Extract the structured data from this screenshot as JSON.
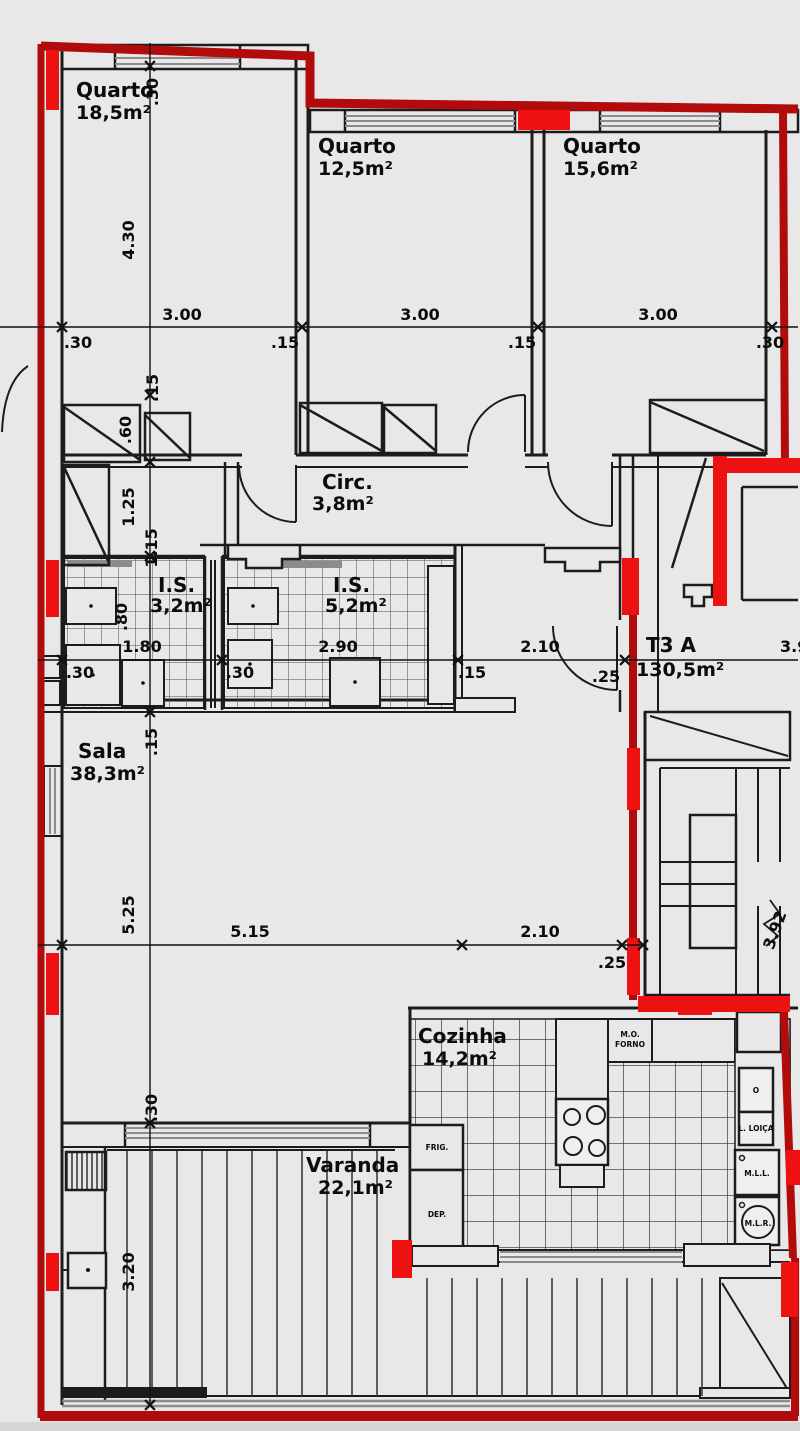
{
  "unit": {
    "code": "T3 A",
    "area": "130,5m²"
  },
  "rooms": {
    "quarto1": {
      "name": "Quarto",
      "area": "18,5m²"
    },
    "quarto2": {
      "name": "Quarto",
      "area": "12,5m²"
    },
    "quarto3": {
      "name": "Quarto",
      "area": "15,6m²"
    },
    "circ": {
      "name": "Circ.",
      "area": "3,8m²"
    },
    "is1": {
      "name": "I.S.",
      "area": "3,2m²"
    },
    "is2": {
      "name": "I.S.",
      "area": "5,2m²"
    },
    "sala": {
      "name": "Sala",
      "area": "38,3m²"
    },
    "cozinha": {
      "name": "Cozinha",
      "area": "14,2m²"
    },
    "varanda": {
      "name": "Varanda",
      "area": "22,1m²"
    }
  },
  "appliances": {
    "mo": "M.O.",
    "forno": "FORNO",
    "frig": "FRIG.",
    "dep": "DEP.",
    "o": "O",
    "lloica": "L. LOIÇA",
    "mll": "M.L.L.",
    "mlr": "M.L.R."
  },
  "dims": {
    "top_30l": ".30",
    "top_300a": "3.00",
    "top_15a": ".15",
    "top_300b": "3.00",
    "top_15b": ".15",
    "top_300c": "3.00",
    "top_30r": ".30",
    "v_30a": ".30",
    "v_430": "4.30",
    "v_15a": ".15",
    "v_60": ".60",
    "v_125": "1.25",
    "v_115": "1.15",
    "v_15b": ".15",
    "v_525": "5.25",
    "v_30b": ".30",
    "v_320": "3.20",
    "mid_80": ".80",
    "mid_180": "1.80",
    "mid_290": "2.90",
    "mid_30a": ".30",
    "mid_30b": ".30",
    "mid_15": ".15",
    "mid_210": "2.10",
    "mid_25": ".25",
    "mid_392": "3.92",
    "low_515": "5.15",
    "low_210": "2.10",
    "low_25": ".25",
    "stair_392": "3.92"
  },
  "colors": {
    "background": "#e8e8e8",
    "boundary_red": "#b20b0b",
    "wall_red": "#ee1111",
    "line_black": "#1c1c1c",
    "window_gray": "#8c8c8c"
  }
}
